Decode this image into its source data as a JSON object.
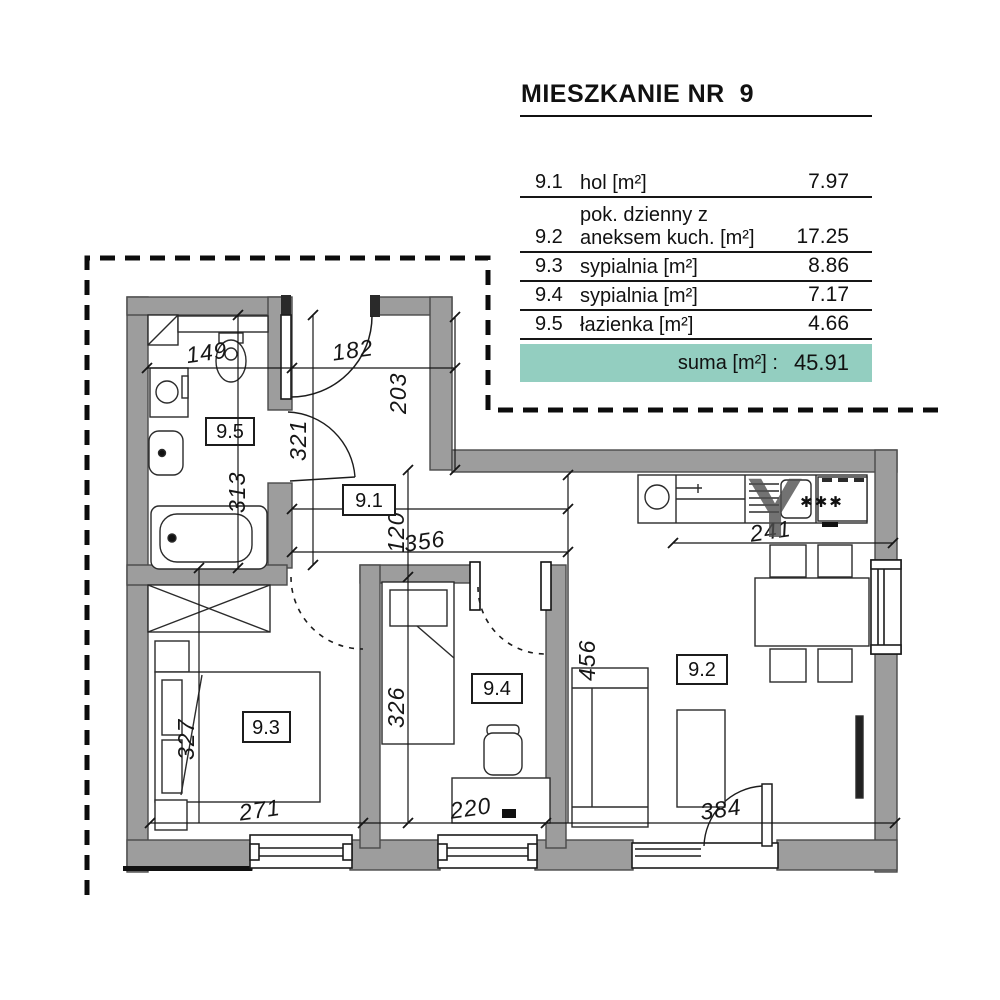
{
  "header": {
    "title": "MIESZKANIE NR  9"
  },
  "table": {
    "rows": [
      {
        "no": "9.1",
        "label1": "hol [m²]",
        "label2": "",
        "value": "7.97"
      },
      {
        "no": "9.2",
        "label1": "pok. dzienny z",
        "label2": "aneksem kuch. [m²]",
        "value": "17.25"
      },
      {
        "no": "9.3",
        "label1": "sypialnia [m²]",
        "label2": "",
        "value": "8.86"
      },
      {
        "no": "9.4",
        "label1": "sypialnia [m²]",
        "label2": "",
        "value": "7.17"
      },
      {
        "no": "9.5",
        "label1": "łazienka [m²]",
        "label2": "",
        "value": "4.66"
      }
    ],
    "suma_label": "suma [m²] :",
    "suma_value": "45.91",
    "accent_color": "#93cec0"
  },
  "plan": {
    "rooms": {
      "hol": "9.1",
      "living": "9.2",
      "bedroom1": "9.3",
      "bedroom2": "9.4",
      "bathroom": "9.5"
    },
    "dims": {
      "w149": "149",
      "w182": "182",
      "w356": "356",
      "w241": "241",
      "w271": "271",
      "w220": "220",
      "w384": "384",
      "h203": "203",
      "h321": "321",
      "h313": "313",
      "h120": "120",
      "h456": "456",
      "h326": "326",
      "h327": "327"
    },
    "stove_symbol": "✱✱✱",
    "watermark": "Y",
    "wall_color": "#9d9d9d"
  }
}
